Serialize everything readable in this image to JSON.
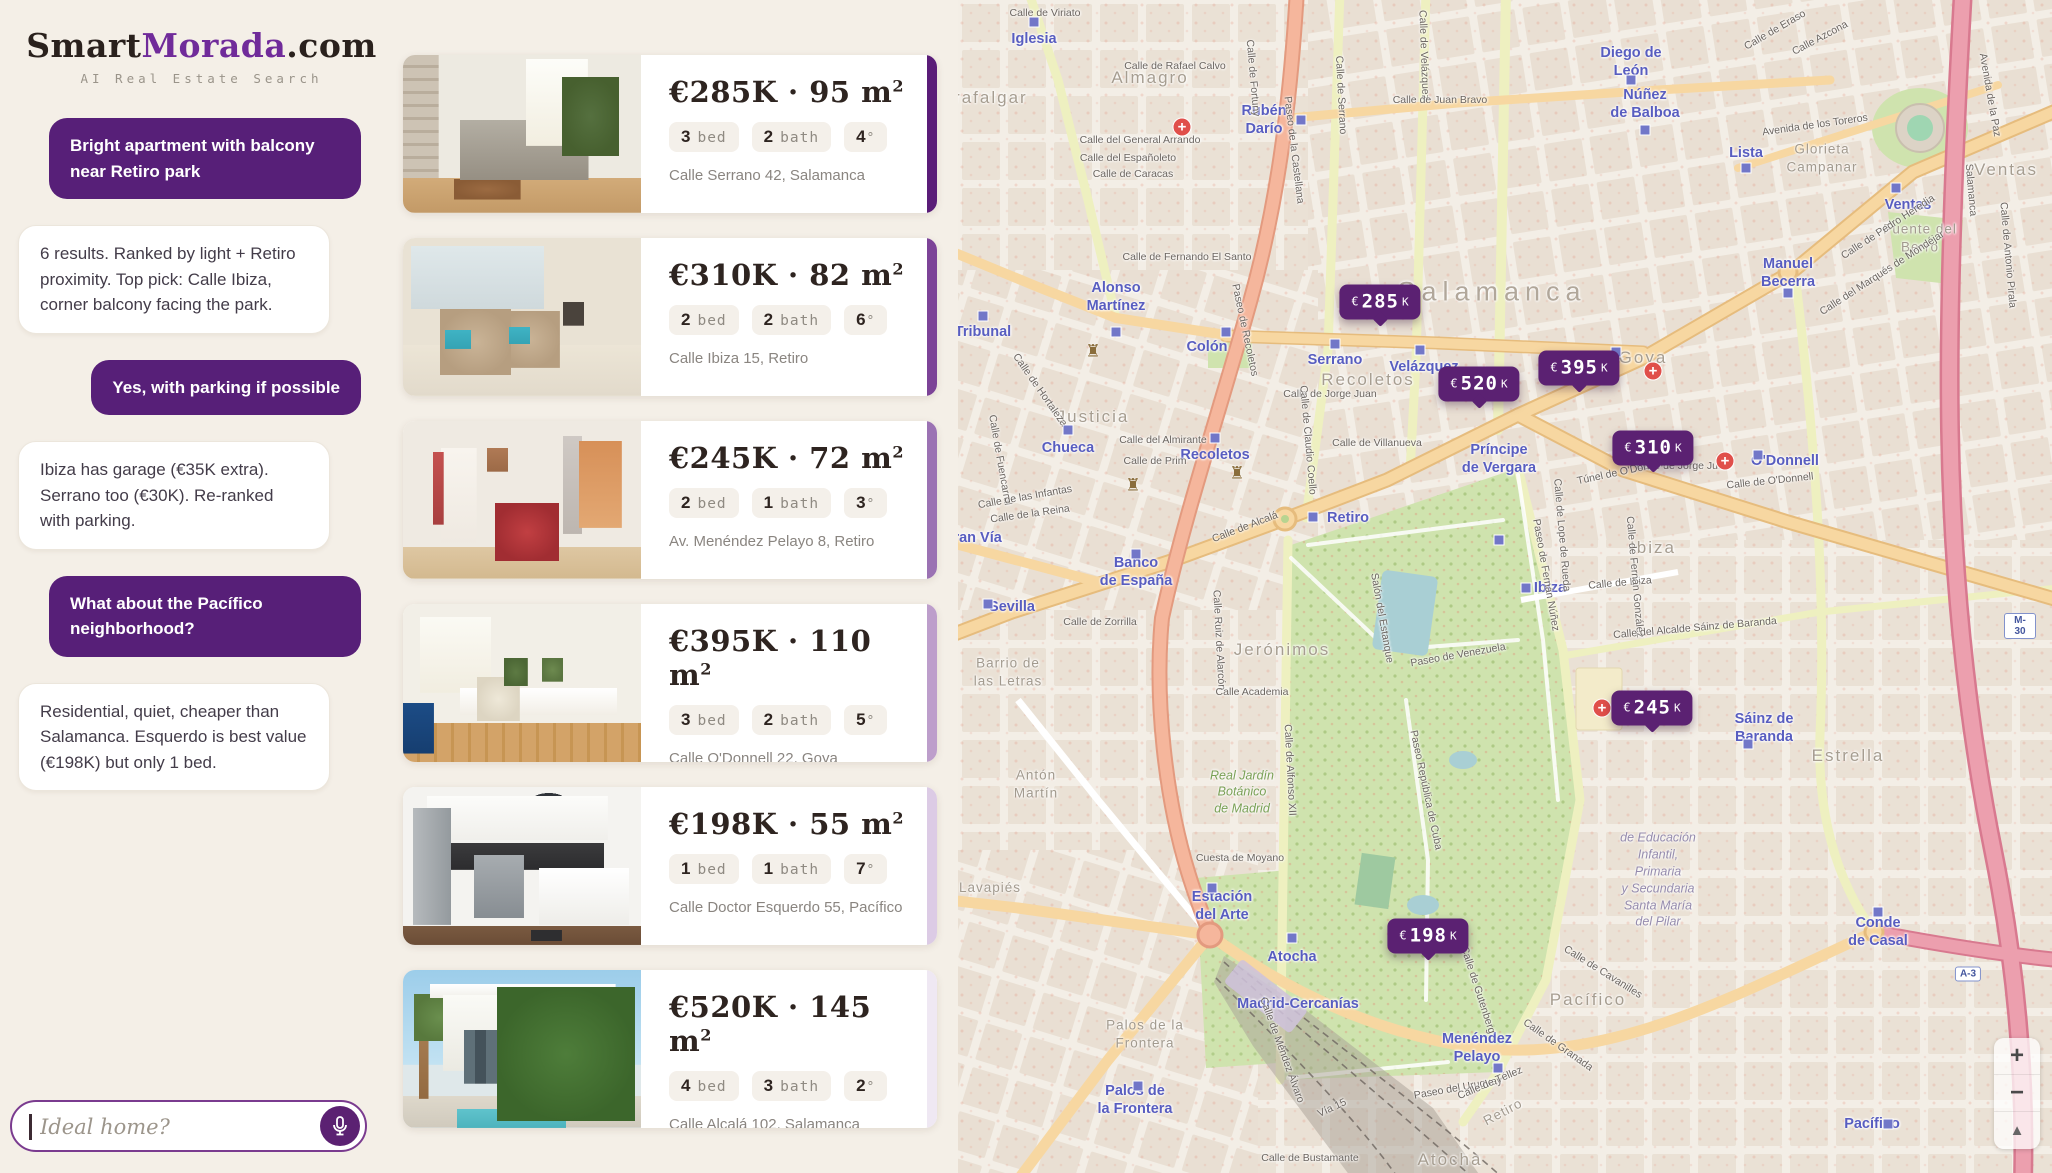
{
  "brand": {
    "smart": "Smart",
    "morada": "Morada",
    "tld": ".com",
    "tagline": "AI Real Estate Search"
  },
  "accent_color": "#5b2172",
  "chat": {
    "messages": [
      {
        "role": "user",
        "text": "Bright apartment with balcony near Retiro park"
      },
      {
        "role": "bot",
        "text": "6 results. Ranked by light + Retiro proximity. Top pick: Calle Ibiza, corner balcony facing the park."
      },
      {
        "role": "user",
        "text": "Yes, with parking if possible"
      },
      {
        "role": "bot",
        "text": "Ibiza has garage (€35K extra). Serrano too (€30K). Re-ranked with parking."
      },
      {
        "role": "user",
        "text": "What about the Pacífico neighborhood?"
      },
      {
        "role": "bot",
        "text": "Residential, quiet, cheaper than Salamanca. Esquerdo is best value (€198K) but only 1 bed."
      }
    ],
    "input_placeholder": "Ideal home?",
    "mic_icon": "microphone-icon"
  },
  "listings": [
    {
      "price": "€285K",
      "area": "95 m",
      "sup": "2",
      "chips": [
        {
          "n": "3",
          "u": "bed"
        },
        {
          "n": "2",
          "u": "bath"
        },
        {
          "n": "4",
          "u": "°"
        }
      ],
      "address": "Calle Serrano 42, Salamanca",
      "rank_color": "#5a1d78",
      "photo_alt": "bright living room with gray sofa and plants"
    },
    {
      "price": "€310K",
      "area": "82 m",
      "sup": "2",
      "chips": [
        {
          "n": "2",
          "u": "bed"
        },
        {
          "n": "2",
          "u": "bath"
        },
        {
          "n": "6",
          "u": "°"
        }
      ],
      "address": "Calle Ibiza 15, Retiro",
      "rank_color": "#7c4397",
      "photo_alt": "beige living room with teal pillows and fireplace"
    },
    {
      "price": "€245K",
      "area": "72 m",
      "sup": "2",
      "chips": [
        {
          "n": "2",
          "u": "bed"
        },
        {
          "n": "1",
          "u": "bath"
        },
        {
          "n": "3",
          "u": "°"
        }
      ],
      "address": "Av. Menéndez Pelayo 8, Retiro",
      "rank_color": "#9b72b3",
      "photo_alt": "white apartment with red armchair"
    },
    {
      "price": "€395K",
      "area": "110 m",
      "sup": "2",
      "chips": [
        {
          "n": "3",
          "u": "bed"
        },
        {
          "n": "2",
          "u": "bath"
        },
        {
          "n": "5",
          "u": "°"
        }
      ],
      "address": "Calle O'Donnell 22, Goya",
      "rank_color": "#bd9ecb",
      "photo_alt": "minimal white room with blue sofa and herringbone floor"
    },
    {
      "price": "€198K",
      "area": "55 m",
      "sup": "2",
      "chips": [
        {
          "n": "1",
          "u": "bed"
        },
        {
          "n": "1",
          "u": "bath"
        },
        {
          "n": "7",
          "u": "°"
        }
      ],
      "address": "Calle Doctor Esquerdo 55, Pacífico",
      "rank_color": "#dccbe5",
      "photo_alt": "white kitchen with dark backsplash"
    },
    {
      "price": "€520K",
      "area": "145 m",
      "sup": "2",
      "chips": [
        {
          "n": "4",
          "u": "bed"
        },
        {
          "n": "3",
          "u": "bath"
        },
        {
          "n": "2",
          "u": "°"
        }
      ],
      "address": "Calle Alcalá 102, Salamanca",
      "rank_color": "#efe8f3",
      "photo_alt": "modern villa exterior with pool and palm"
    }
  ],
  "price_separator": "·",
  "map": {
    "markers": [
      {
        "cur": "€",
        "num": "285",
        "k": "K",
        "x": 422,
        "y": 302
      },
      {
        "cur": "€",
        "num": "520",
        "k": "K",
        "x": 521,
        "y": 384
      },
      {
        "cur": "€",
        "num": "395",
        "k": "K",
        "x": 621,
        "y": 368
      },
      {
        "cur": "€",
        "num": "310",
        "k": "K",
        "x": 695,
        "y": 448
      },
      {
        "cur": "€",
        "num": "245",
        "k": "K",
        "x": 694,
        "y": 708
      },
      {
        "cur": "€",
        "num": "198",
        "k": "K",
        "x": 470,
        "y": 936
      }
    ],
    "controls": {
      "zoom_in": "+",
      "zoom_out": "−",
      "compass": "▲"
    },
    "labels": [
      {
        "t": "Iglesia",
        "c": "m",
        "x": 76,
        "y": 39
      },
      {
        "t": "Rubén\nDarío",
        "c": "m",
        "x": 306,
        "y": 120
      },
      {
        "t": "Alonso\nMartínez",
        "c": "m",
        "x": 158,
        "y": 297
      },
      {
        "t": "Tribunal",
        "c": "m",
        "x": 25,
        "y": 332
      },
      {
        "t": "Colón",
        "c": "m",
        "x": 249,
        "y": 347
      },
      {
        "t": "Chueca",
        "c": "m",
        "x": 110,
        "y": 448
      },
      {
        "t": "Recoletos",
        "c": "m",
        "x": 257,
        "y": 455
      },
      {
        "t": "Serrano",
        "c": "m",
        "x": 377,
        "y": 360
      },
      {
        "t": "Velázquez",
        "c": "m",
        "x": 466,
        "y": 367
      },
      {
        "t": "Gran Vía",
        "c": "m",
        "x": 14,
        "y": 538
      },
      {
        "t": "Banco\nde España",
        "c": "m",
        "x": 178,
        "y": 572
      },
      {
        "t": "Sevilla",
        "c": "m",
        "x": 54,
        "y": 607
      },
      {
        "t": "Retiro",
        "c": "m",
        "x": 390,
        "y": 518
      },
      {
        "t": "Ibiza",
        "c": "m",
        "x": 592,
        "y": 588
      },
      {
        "t": "Príncipe\nde Vergara",
        "c": "m",
        "x": 541,
        "y": 459
      },
      {
        "t": "O'Donnell",
        "c": "m",
        "x": 827,
        "y": 461
      },
      {
        "t": "Diego de\nLeón",
        "c": "m",
        "x": 673,
        "y": 62
      },
      {
        "t": "Núñez\nde Balboa",
        "c": "m",
        "x": 687,
        "y": 104
      },
      {
        "t": "Lista",
        "c": "m",
        "x": 788,
        "y": 153
      },
      {
        "t": "Manuel\nBecerra",
        "c": "m",
        "x": 830,
        "y": 273
      },
      {
        "t": "Ventas",
        "c": "m",
        "x": 950,
        "y": 205
      },
      {
        "t": "Sáinz de\nBaranda",
        "c": "m",
        "x": 806,
        "y": 728
      },
      {
        "t": "Conde\nde Casal",
        "c": "m",
        "x": 920,
        "y": 932
      },
      {
        "t": "Pacífico",
        "c": "m",
        "x": 914,
        "y": 1124
      },
      {
        "t": "Menéndez\nPelayo",
        "c": "m",
        "x": 519,
        "y": 1048
      },
      {
        "t": "Atocha",
        "c": "m",
        "x": 334,
        "y": 957
      },
      {
        "t": "Madrid-Cercanías",
        "c": "m",
        "x": 340,
        "y": 1004
      },
      {
        "t": "Estación\ndel Arte",
        "c": "m",
        "x": 264,
        "y": 906
      },
      {
        "t": "Palos de\nla Frontera",
        "c": "m",
        "x": 177,
        "y": 1100
      },
      {
        "t": "Trafalgar",
        "c": "a",
        "x": 27,
        "y": 98
      },
      {
        "t": "Almagro",
        "c": "a",
        "x": 192,
        "y": 78
      },
      {
        "t": "Justicia",
        "c": "a",
        "x": 135,
        "y": 417
      },
      {
        "t": "Recoletos",
        "c": "a",
        "x": 410,
        "y": 380
      },
      {
        "t": "Salamanca",
        "c": "al",
        "x": 534,
        "y": 292
      },
      {
        "t": "Goya",
        "c": "a",
        "x": 685,
        "y": 358
      },
      {
        "t": "Ventas",
        "c": "a",
        "x": 1048,
        "y": 170
      },
      {
        "t": "Ibiza",
        "c": "a",
        "x": 695,
        "y": 548
      },
      {
        "t": "Jerónimos",
        "c": "a",
        "x": 324,
        "y": 650
      },
      {
        "t": "Estrella",
        "c": "a",
        "x": 890,
        "y": 756
      },
      {
        "t": "Pacífico",
        "c": "a",
        "x": 630,
        "y": 1000
      },
      {
        "t": "Atocha",
        "c": "a",
        "x": 492,
        "y": 1160
      },
      {
        "t": "Lavapiés",
        "c": "asm",
        "x": 32,
        "y": 888
      },
      {
        "t": "Barrio de\nlas Letras",
        "c": "asm",
        "x": 50,
        "y": 672
      },
      {
        "t": "Antón\nMartín",
        "c": "asm",
        "x": 78,
        "y": 784
      },
      {
        "t": "Palos de la\nFrontera",
        "c": "asm",
        "x": 187,
        "y": 1034
      },
      {
        "t": "Glorieta\nCampanar",
        "c": "asm",
        "x": 864,
        "y": 158
      },
      {
        "t": "Fuente del\nBerro",
        "c": "asm",
        "x": 962,
        "y": 238
      },
      {
        "t": "Retiro",
        "c": "asm",
        "x": 545,
        "y": 1112,
        "r": -28
      },
      {
        "t": "Calle de Viriato",
        "c": "s",
        "x": 87,
        "y": 13
      },
      {
        "t": "Calle de Rafael Calvo",
        "c": "s",
        "x": 217,
        "y": 66
      },
      {
        "t": "Calle del General Arrando",
        "c": "s",
        "x": 182,
        "y": 140
      },
      {
        "t": "Calle del Españoleto",
        "c": "s",
        "x": 170,
        "y": 158
      },
      {
        "t": "Calle de Caracas",
        "c": "s",
        "x": 175,
        "y": 174
      },
      {
        "t": "Calle de Fernando El Santo",
        "c": "s",
        "x": 229,
        "y": 257
      },
      {
        "t": "Calle de Fortuny",
        "c": "s",
        "x": 295,
        "y": 78,
        "r": 85
      },
      {
        "t": "Paseo de la Castellana",
        "c": "s",
        "x": 336,
        "y": 150,
        "r": 83
      },
      {
        "t": "Calle de Serrano",
        "c": "s",
        "x": 383,
        "y": 95,
        "r": 87
      },
      {
        "t": "Calle de Velázquez",
        "c": "s",
        "x": 466,
        "y": 55,
        "r": 88
      },
      {
        "t": "Calle de Juan Bravo",
        "c": "s",
        "x": 482,
        "y": 100
      },
      {
        "t": "Paseo de Recoletos",
        "c": "s",
        "x": 287,
        "y": 330,
        "r": 78
      },
      {
        "t": "Calle de Hortaleza",
        "c": "s",
        "x": 82,
        "y": 390,
        "r": 55
      },
      {
        "t": "Calle de Fuencarral",
        "c": "s",
        "x": 42,
        "y": 460,
        "r": 80
      },
      {
        "t": "Calle del Almirante",
        "c": "s",
        "x": 205,
        "y": 440
      },
      {
        "t": "Calle de Prim",
        "c": "s",
        "x": 197,
        "y": 461
      },
      {
        "t": "Calle de las Infantas",
        "c": "s",
        "x": 67,
        "y": 497,
        "r": -10
      },
      {
        "t": "Calle de la Reina",
        "c": "s",
        "x": 72,
        "y": 514,
        "r": -8
      },
      {
        "t": "Calle de Zorrilla",
        "c": "s",
        "x": 142,
        "y": 622
      },
      {
        "t": "Calle de Alcalá",
        "c": "s",
        "x": 287,
        "y": 527,
        "r": -21
      },
      {
        "t": "Calle de Jorge Juan",
        "c": "s",
        "x": 372,
        "y": 394
      },
      {
        "t": "Calle de Jorge Juan",
        "c": "s",
        "x": 725,
        "y": 466
      },
      {
        "t": "Calle de Villanueva",
        "c": "s",
        "x": 419,
        "y": 443
      },
      {
        "t": "Calle de Claudio Coello",
        "c": "s",
        "x": 350,
        "y": 440,
        "r": 85
      },
      {
        "t": "Túnel de O'Donnell",
        "c": "s",
        "x": 663,
        "y": 472,
        "r": -12
      },
      {
        "t": "Calle de O'Donnell",
        "c": "s",
        "x": 812,
        "y": 481,
        "r": -6
      },
      {
        "t": "Calle de Alfonso XII",
        "c": "s",
        "x": 332,
        "y": 770,
        "r": 87
      },
      {
        "t": "Calle Ruiz de Alarcón",
        "c": "s",
        "x": 261,
        "y": 640,
        "r": 87
      },
      {
        "t": "Calle Academia",
        "c": "s",
        "x": 294,
        "y": 692
      },
      {
        "t": "Salón del Estanque",
        "c": "s",
        "x": 424,
        "y": 618,
        "r": 80
      },
      {
        "t": "Paseo de Venezuela",
        "c": "s",
        "x": 500,
        "y": 655,
        "r": -10
      },
      {
        "t": "Paseo de Fernán Núñez",
        "c": "s",
        "x": 588,
        "y": 575,
        "r": 80
      },
      {
        "t": "Paseo República de Cuba",
        "c": "s",
        "x": 468,
        "y": 790,
        "r": 78
      },
      {
        "t": "Paseo del Uruguay",
        "c": "s",
        "x": 500,
        "y": 1088,
        "r": -10
      },
      {
        "t": "Calle de Ibiza",
        "c": "s",
        "x": 662,
        "y": 583,
        "r": -5
      },
      {
        "t": "Calle de Lope de Rueda",
        "c": "s",
        "x": 604,
        "y": 535,
        "r": 85
      },
      {
        "t": "Calle de Fernán González",
        "c": "s",
        "x": 677,
        "y": 577,
        "r": 85
      },
      {
        "t": "Calle del Alcalde Sáinz de Baranda",
        "c": "s",
        "x": 737,
        "y": 628,
        "r": -5
      },
      {
        "t": "Avenida de los Toreros",
        "c": "s",
        "x": 857,
        "y": 125,
        "r": -8
      },
      {
        "t": "Calle de Eraso",
        "c": "s",
        "x": 817,
        "y": 30,
        "r": -30
      },
      {
        "t": "Calle Azcona",
        "c": "s",
        "x": 862,
        "y": 38,
        "r": -28
      },
      {
        "t": "Avenida de la Paz",
        "c": "s",
        "x": 1032,
        "y": 95,
        "r": 80
      },
      {
        "t": "Salamanca",
        "c": "s",
        "x": 1013,
        "y": 190,
        "r": 85
      },
      {
        "t": "Calle de Pedro Heredia",
        "c": "s",
        "x": 930,
        "y": 227,
        "r": -33
      },
      {
        "t": "Calle del Marqués de Mondéjar",
        "c": "s",
        "x": 924,
        "y": 273,
        "r": -33
      },
      {
        "t": "Calle de Antonio Pirala",
        "c": "s",
        "x": 1050,
        "y": 255,
        "r": 85
      },
      {
        "t": "Cuesta de Moyano",
        "c": "s",
        "x": 282,
        "y": 858
      },
      {
        "t": "Calle de Méndez Álvaro",
        "c": "s",
        "x": 324,
        "y": 1050,
        "r": 70
      },
      {
        "t": "Calle de Bustamante",
        "c": "s",
        "x": 352,
        "y": 1158
      },
      {
        "t": "Vía 15",
        "c": "s",
        "x": 374,
        "y": 1108,
        "r": -25
      },
      {
        "t": "Calle de Gutenberg",
        "c": "s",
        "x": 520,
        "y": 990,
        "r": 72
      },
      {
        "t": "Calle de Téllez",
        "c": "s",
        "x": 532,
        "y": 1083,
        "r": -23
      },
      {
        "t": "Calle de Cavanilles",
        "c": "s",
        "x": 645,
        "y": 972,
        "r": 32
      },
      {
        "t": "Calle de Granada",
        "c": "s",
        "x": 600,
        "y": 1045,
        "r": 35
      },
      {
        "t": "Real Jardín\nBotánico\nde Madrid",
        "c": "p",
        "x": 284,
        "y": 792
      },
      {
        "t": "de Educación\nInfantil,\nPrimaria\ny Secundaria\nSanta María\ndel Pilar",
        "c": "o",
        "x": 700,
        "y": 880
      },
      {
        "t": "M-30",
        "c": "h",
        "x": 1062,
        "y": 626
      },
      {
        "t": "A-3",
        "c": "h",
        "x": 1010,
        "y": 974
      }
    ],
    "pois": {
      "hospitals": [
        [
          224,
          127
        ],
        [
          695,
          371
        ],
        [
          767,
          461
        ],
        [
          644,
          708
        ]
      ],
      "metro_squares": [
        [
          76,
          22
        ],
        [
          343,
          120
        ],
        [
          268,
          332
        ],
        [
          158,
          332
        ],
        [
          25,
          316
        ],
        [
          110,
          430
        ],
        [
          257,
          438
        ],
        [
          377,
          344
        ],
        [
          462,
          350
        ],
        [
          658,
          352
        ],
        [
          800,
          455
        ],
        [
          673,
          80
        ],
        [
          687,
          130
        ],
        [
          788,
          168
        ],
        [
          830,
          293
        ],
        [
          938,
          188
        ],
        [
          355,
          517
        ],
        [
          568,
          588
        ],
        [
          541,
          540
        ],
        [
          790,
          744
        ],
        [
          920,
          912
        ],
        [
          930,
          1124
        ],
        [
          540,
          1068
        ],
        [
          334,
          938
        ],
        [
          254,
          888
        ],
        [
          178,
          554
        ],
        [
          30,
          604
        ],
        [
          180,
          1086
        ]
      ],
      "castles": [
        [
          135,
          351
        ],
        [
          279,
          473
        ],
        [
          175,
          485
        ]
      ]
    }
  }
}
